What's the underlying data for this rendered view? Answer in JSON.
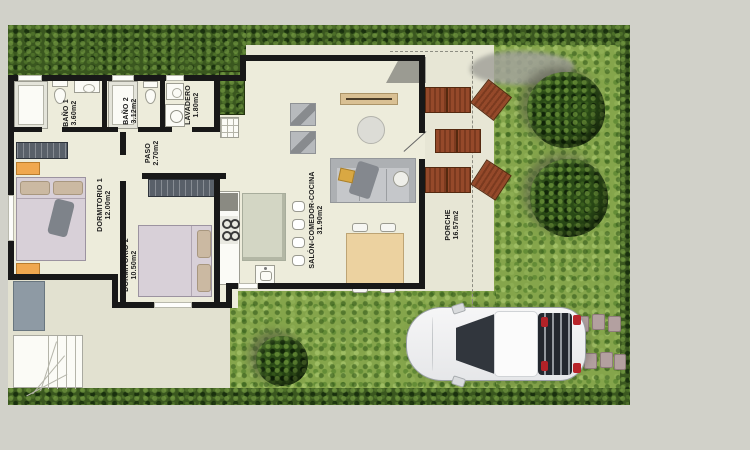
{
  "plan": {
    "title": "Single-storey villa floor plan with garden, porch and driveway",
    "rooms": [
      {
        "id": "bano1",
        "name": "BAÑO 1",
        "area": "3.60m2"
      },
      {
        "id": "bano2",
        "name": "BAÑO 2",
        "area": "3.12m2"
      },
      {
        "id": "lavadero",
        "name": "LAVADERO",
        "area": "1.80m2"
      },
      {
        "id": "paso",
        "name": "PASO",
        "area": "2.70m2"
      },
      {
        "id": "dormitorio1",
        "name": "DORMITORIO 1",
        "area": "12.00m2"
      },
      {
        "id": "dormitorio2",
        "name": "DORMITORIO 2",
        "area": "10.50m2"
      },
      {
        "id": "salon",
        "name": "SALÓN-COMEDOR-COCINA",
        "area": "31.90m2"
      },
      {
        "id": "porche",
        "name": "PORCHE",
        "area": "16.57m2"
      }
    ],
    "colors": {
      "background": "#d1d1c9",
      "floor": "#edecdb",
      "walls": "#181818",
      "grass": "#85a54b",
      "hedge": "#3a571f",
      "lounger_wood": "#8a4124",
      "bed_linen": "#d8d0d8",
      "nightstand": "#f0a84f",
      "car_body": "#f2f2f3"
    }
  }
}
